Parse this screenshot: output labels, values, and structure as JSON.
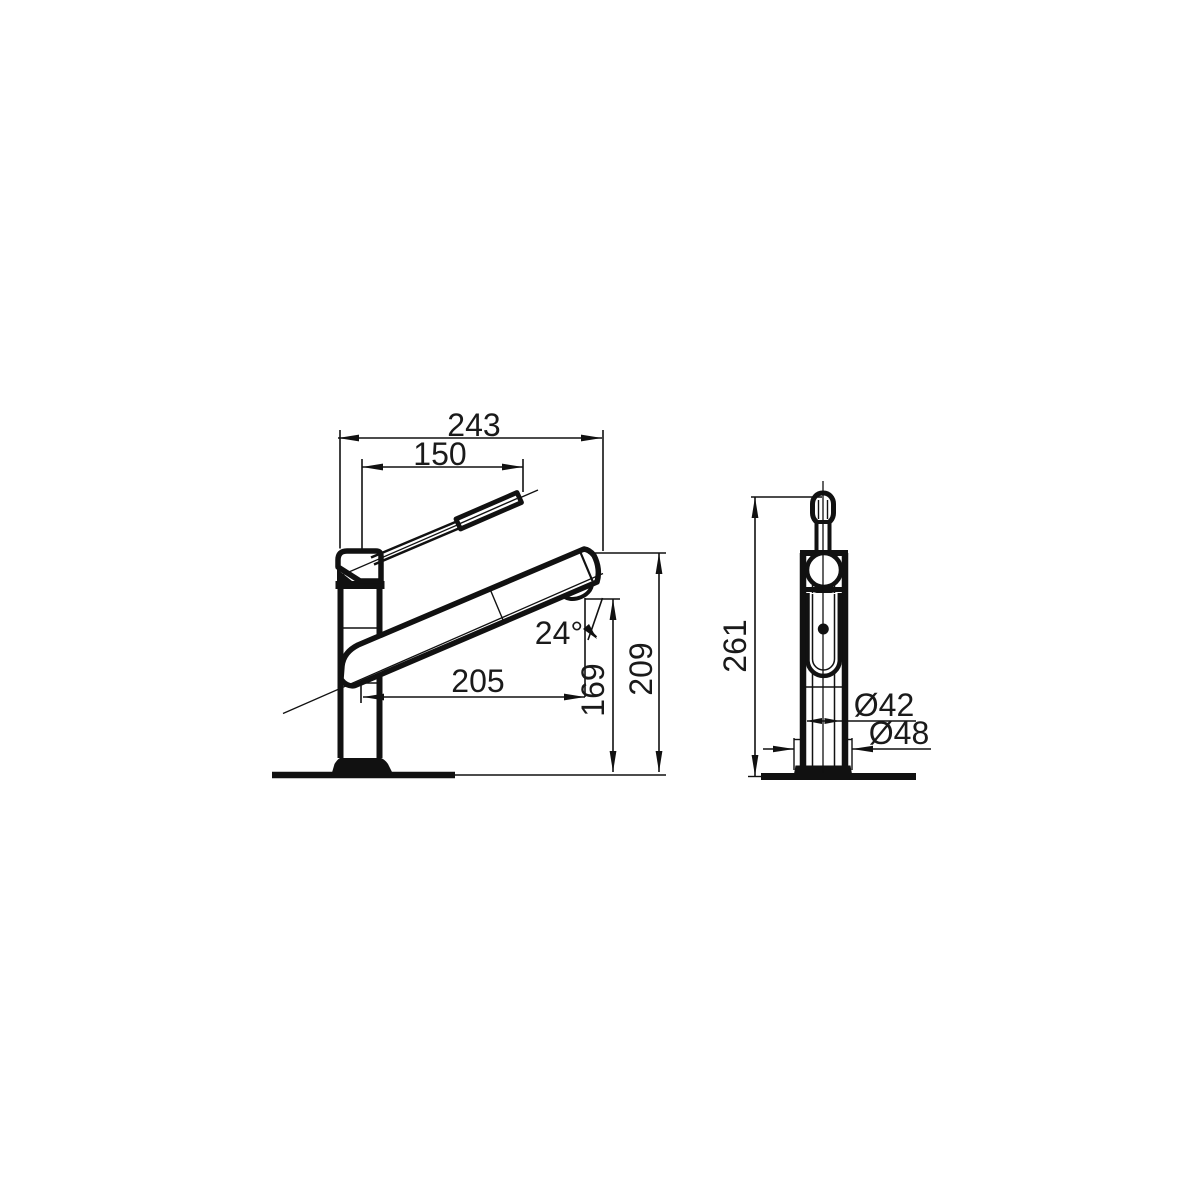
{
  "canvas": {
    "background": "#ffffff",
    "line_color": "#111111",
    "text_color": "#1a1a1a"
  },
  "dimensions": {
    "side_view": {
      "overall_reach": "243",
      "lever_reach": "150",
      "spout_reach": "205",
      "spout_angle": "24°",
      "outlet_height": "169",
      "spout_top_height": "209"
    },
    "front_view": {
      "overall_height": "261",
      "body_diameter": "Ø42",
      "base_diameter": "Ø48"
    }
  }
}
